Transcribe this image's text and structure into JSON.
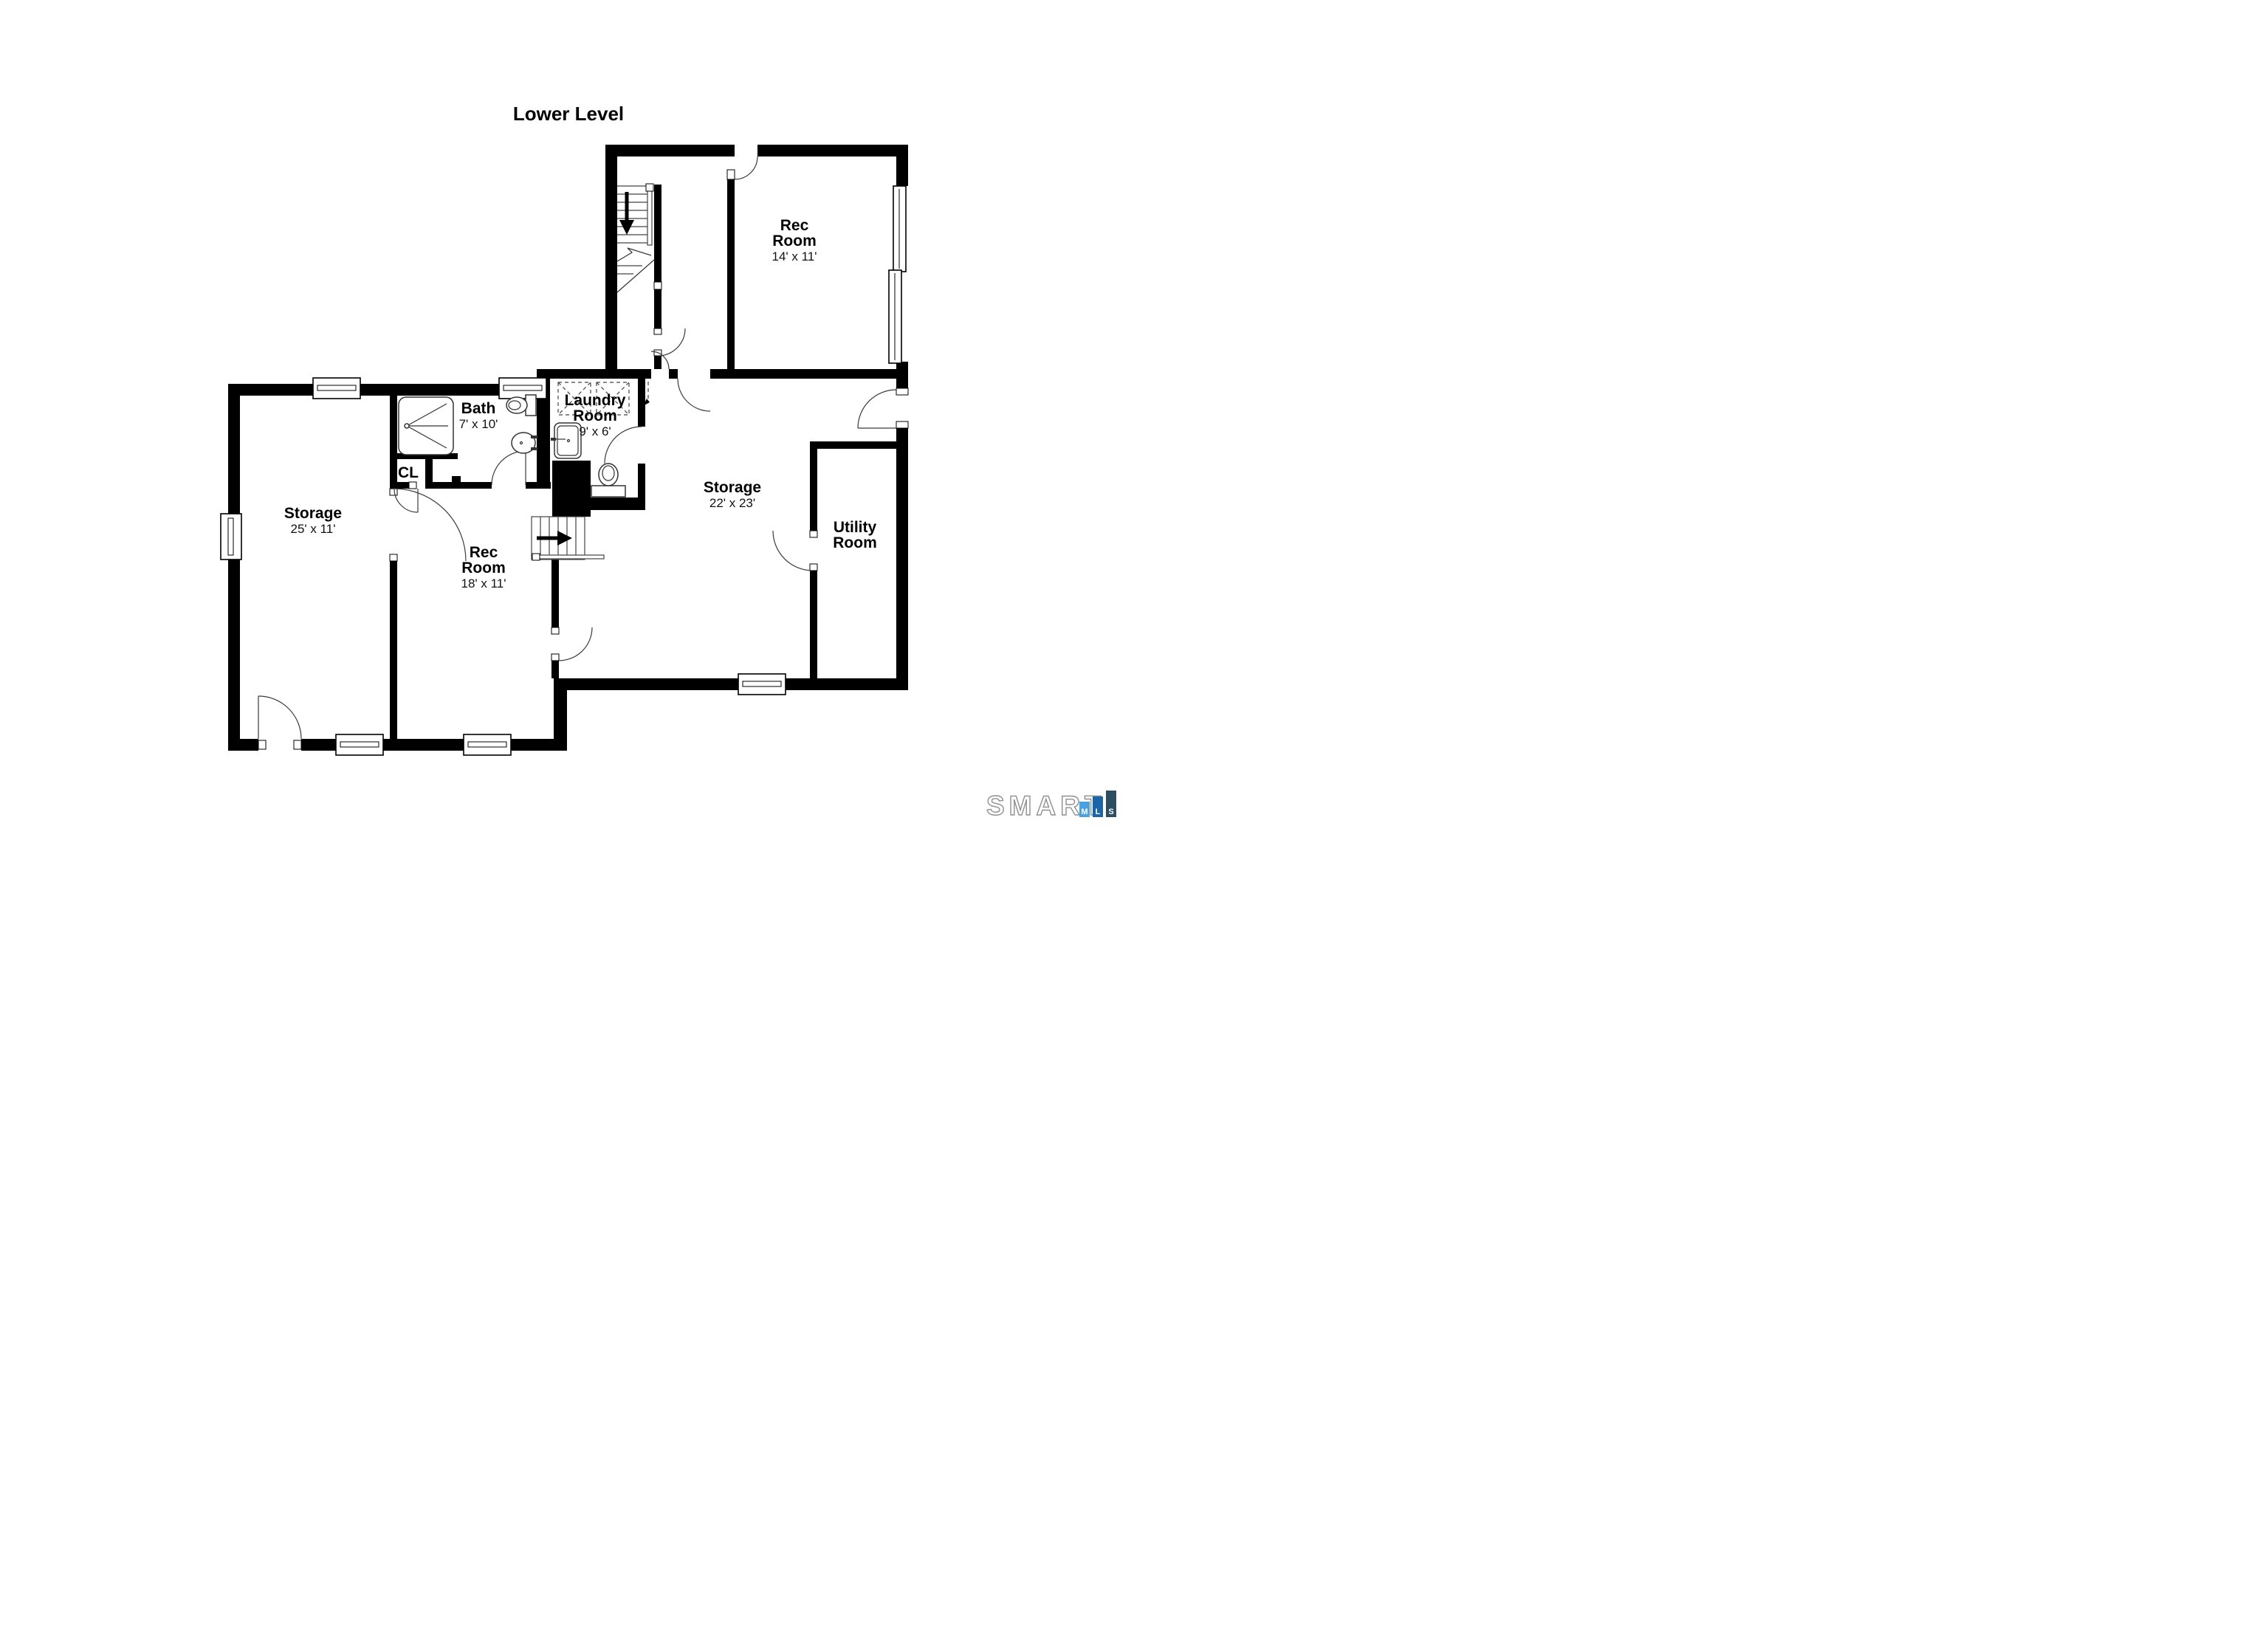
{
  "title": "Lower Level",
  "rooms": {
    "rec_upper": {
      "name_line1": "Rec",
      "name_line2": "Room",
      "dims": "14' x 11'"
    },
    "laundry": {
      "name_line1": "Laundry",
      "name_line2": "Room",
      "dims": "9' x 6'"
    },
    "bath": {
      "name": "Bath",
      "dims": "7' x 10'"
    },
    "closet": {
      "name": "CL"
    },
    "storage_left": {
      "name": "Storage",
      "dims": "25' x 11'"
    },
    "rec_lower": {
      "name_line1": "Rec",
      "name_line2": "Room",
      "dims": "18' x 11'"
    },
    "storage_right": {
      "name": "Storage",
      "dims": "22' x 23'"
    },
    "utility": {
      "name_line1": "Utility",
      "name_line2": "Room"
    }
  },
  "fixtures": {
    "shower": "shower-pan-icon",
    "bath_toilet": "toilet-icon",
    "bath_sink": "sink-icon",
    "laundry_sink": "utility-sink-icon",
    "wc_toilet": "toilet-icon",
    "washer": "washer-icon",
    "dryer": "dryer-icon",
    "stairs_upper": "stairs-down-arrow-icon",
    "stairs_lower": "stairs-up-arrow-icon"
  },
  "logo": {
    "brand": "SMART",
    "bars": [
      {
        "letter": "M",
        "color": "#4aa3e0"
      },
      {
        "letter": "L",
        "color": "#1b66ab"
      },
      {
        "letter": "S",
        "color": "#2d4d60"
      }
    ],
    "outline_color": "#8f8f8f"
  },
  "colors": {
    "wall": "#000000",
    "line": "#3a3a3a",
    "background": "#ffffff"
  }
}
